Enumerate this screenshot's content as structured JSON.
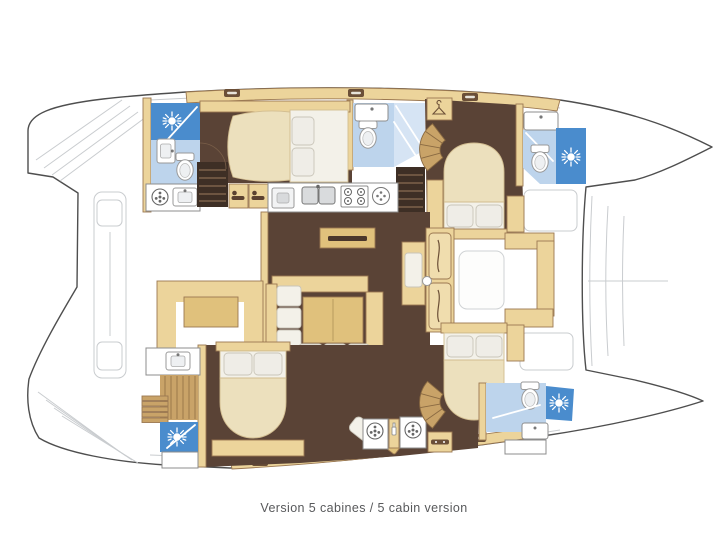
{
  "caption": "Version 5 cabines / 5 cabin version",
  "diagram": {
    "type": "yacht-floor-plan",
    "vessel": "sailing catamaran, top view, bow at right",
    "areas": [
      "port aft bathroom with shower",
      "port aft cabin double bed",
      "port mid bathroom",
      "port forward cabin double bed",
      "bow bathroom with shower",
      "galley with double sink and stove",
      "salon dining table with sofas",
      "cockpit settee with table",
      "forward cockpit seat",
      "starboard aft bathroom with shower",
      "starboard aft cabin double bed",
      "starboard forward cabin double bed",
      "starboard mid bathroom with shower",
      "laundry washers",
      "companionway stairs",
      "stern platforms",
      "bow trampoline"
    ]
  },
  "icons": [
    "shower-sun-icon",
    "toilet-icon",
    "sink-icon",
    "washer-icon",
    "stove-burner-icon",
    "double-sink-icon",
    "hanger-icon",
    "drawer-icon",
    "hatch-icon",
    "berth-icon",
    "bottle-icon"
  ],
  "colors": {
    "outline": "#4e4e4e",
    "faint": "#c9cccf",
    "floor_brown": "#5a4336",
    "stair": "#3e2f25",
    "wood": "#c9a368",
    "tan": "#ecd49b",
    "tan_dark": "#e0c17c",
    "wall": "#9b7851",
    "cream": "#ece0bd",
    "linen": "#f3f1e9",
    "pillow": "#efede7",
    "shower_blue": "#4a8ccd",
    "bath_blue": "#bdd4ec",
    "glass_blue": "#d6e4f4",
    "fixture": "#8c8c8c",
    "caption_color": "#58595b"
  }
}
